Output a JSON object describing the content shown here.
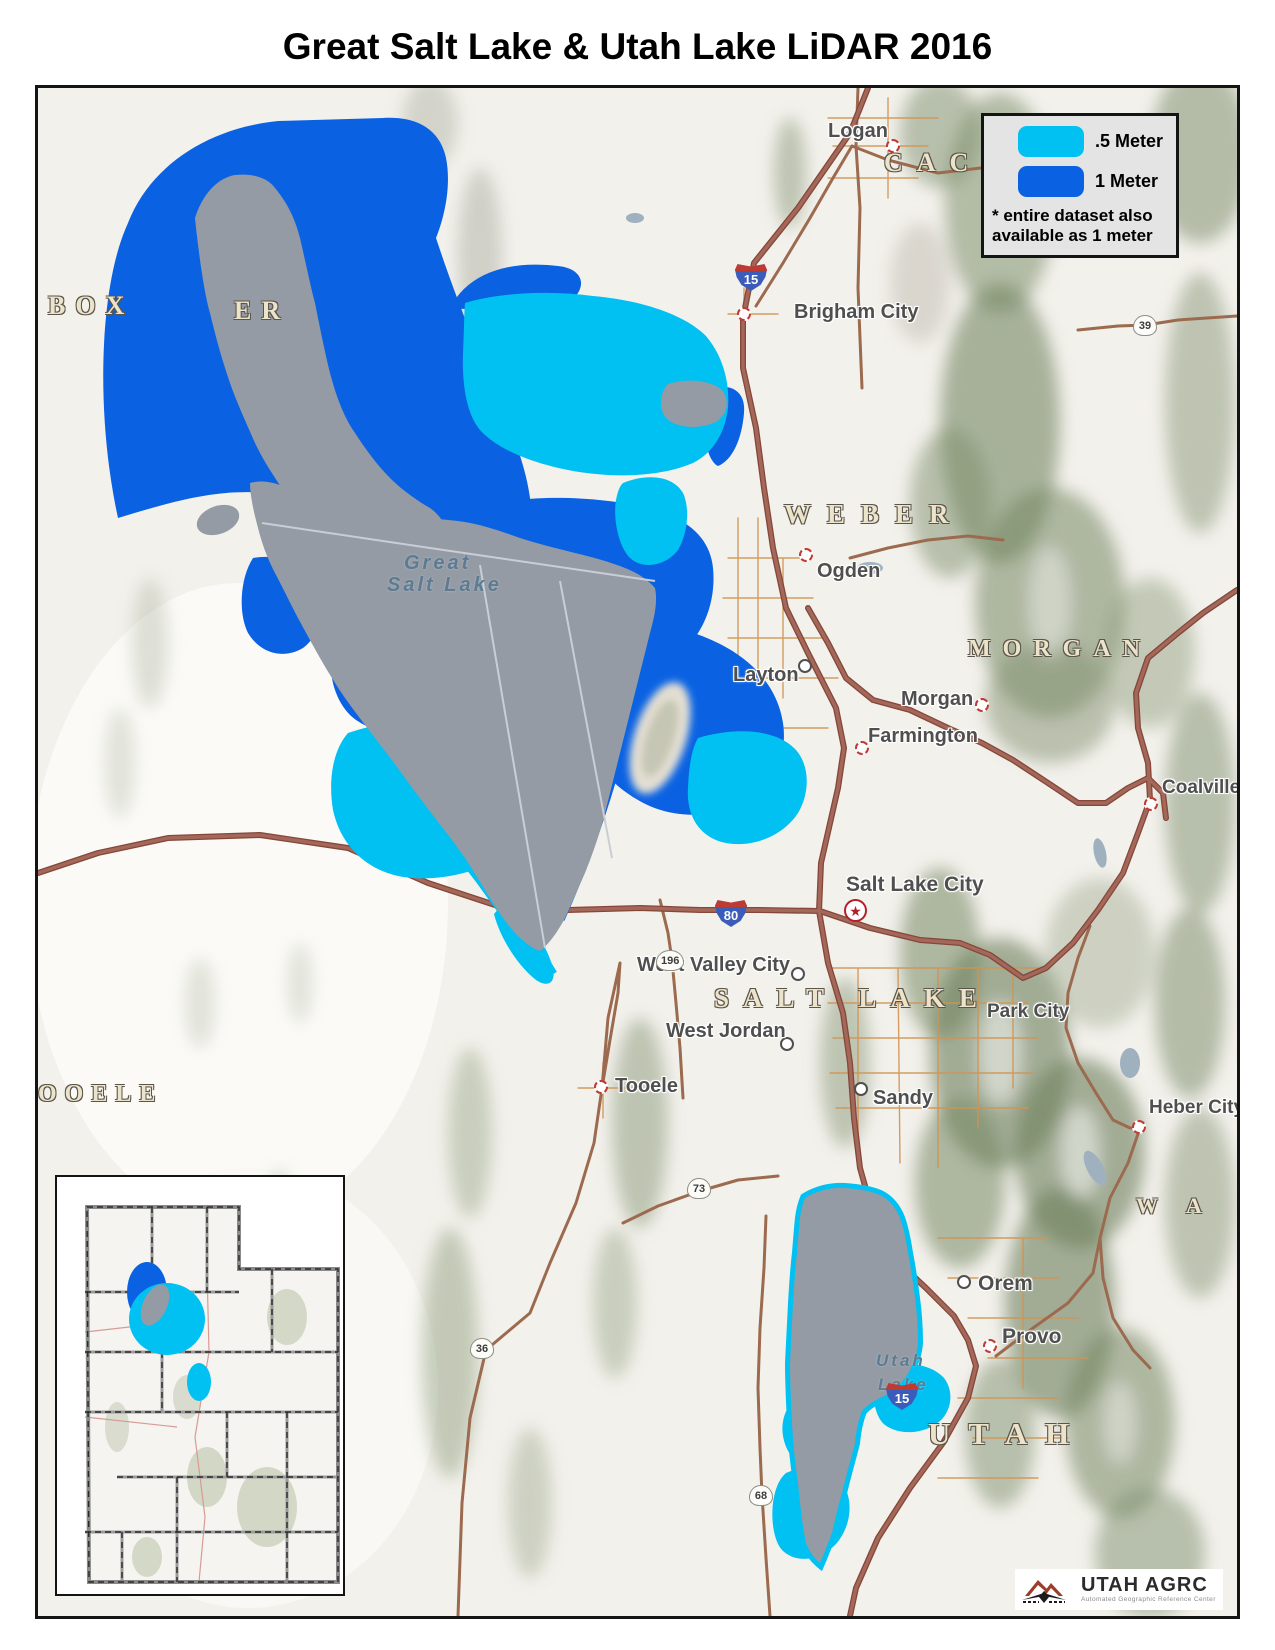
{
  "title": "Great Salt Lake & Utah Lake LiDAR 2016",
  "legend": {
    "items": [
      {
        "label": ".5 Meter",
        "color": "#00c1f1"
      },
      {
        "label": "1 Meter",
        "color": "#0a62e3"
      }
    ],
    "note_line1": "* entire dataset also",
    "note_line2": "available as 1 meter"
  },
  "map": {
    "colors": {
      "half_meter_coverage": "#00c1f1",
      "one_meter_coverage": "#0a62e3",
      "lake_fill": "#949ba4",
      "major_road": "#a4685a"
    },
    "cities": {
      "logan": "Logan",
      "brigham_city": "Brigham City",
      "ogden": "Ogden",
      "layton": "Layton",
      "morgan": "Morgan",
      "farmington": "Farmington",
      "salt_lake_city": "Salt Lake City",
      "west_valley_city": "West Valley City",
      "west_jordan": "West Jordan",
      "sandy": "Sandy",
      "tooele": "Tooele",
      "park_city": "Park City",
      "coalville": "Coalville",
      "heber_city": "Heber City",
      "orem": "Orem",
      "provo": "Provo"
    },
    "counties": {
      "box_elder_a": "BOX",
      "box_elder_b": "ER",
      "cache": "CACHE",
      "weber": "WEBER",
      "morgan": "MORGAN",
      "salt_lake": "SALT LAKE",
      "tooele": "OOELE",
      "utah": "UTAH",
      "wasatch": "W A"
    },
    "lakes": {
      "gsl_line1": "Great",
      "gsl_line2": "Salt Lake",
      "utah_line1": "Utah",
      "utah_line2": "Lake"
    },
    "routes": {
      "i15_north": "15",
      "i80": "80",
      "i15_south": "15",
      "sr39": "39",
      "sr196": "196",
      "sr73": "73",
      "sr36": "36",
      "sr68": "68"
    },
    "capital_star": "★"
  },
  "logo": {
    "name": "UTAH AGRC",
    "subtitle": "Automated Geographic Reference Center"
  }
}
